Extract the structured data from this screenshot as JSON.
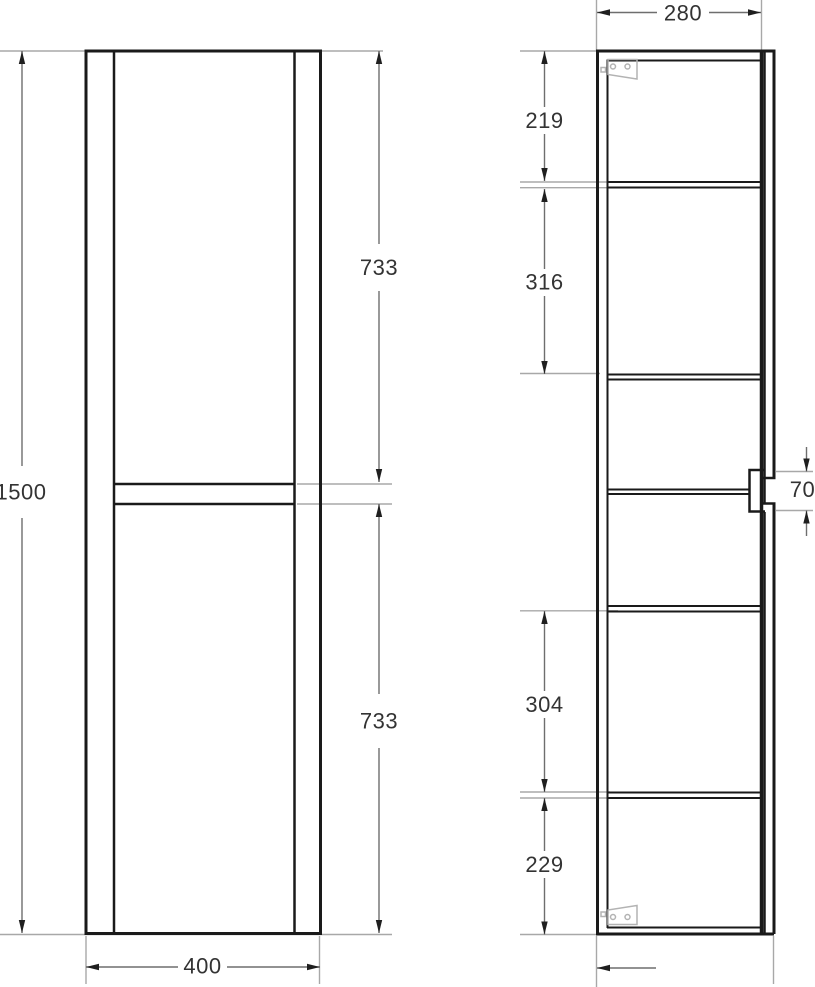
{
  "drawing": {
    "type": "cabinet-technical-drawing",
    "views": {
      "front": {
        "label": "front-view"
      },
      "side": {
        "label": "side-section-view"
      }
    },
    "dimensions": {
      "height": "1500",
      "width": "400",
      "depth": "280",
      "upper_door": "733",
      "lower_door": "733",
      "section_top": "219",
      "section_upper_mid": "316",
      "section_lower_mid": "304",
      "section_bottom": "229",
      "handle": "70"
    },
    "icons": {
      "top_bracket": "corner-bracket-icon",
      "bottom_bracket": "corner-bracket-icon"
    },
    "colors": {
      "outline": "#1a1a1a",
      "dimension_line": "#6e6e6e",
      "extension_line": "#a8a8a8",
      "label_text": "#333333",
      "bracket": "#b3b3b3",
      "background": "#ffffff"
    }
  }
}
